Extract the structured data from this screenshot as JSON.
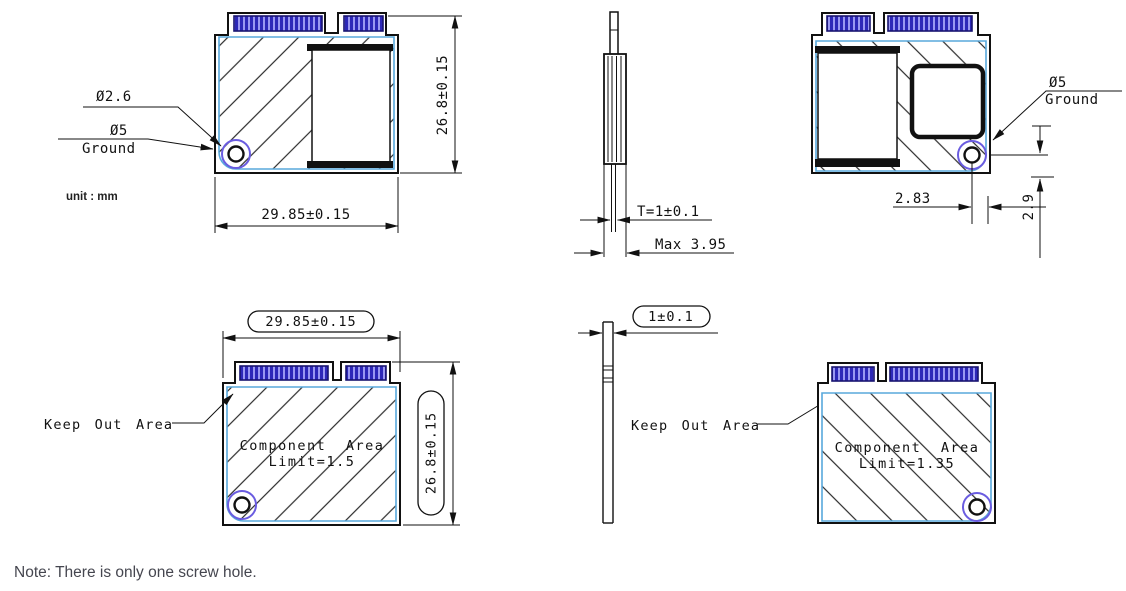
{
  "note": "Note: There is only one screw hole.",
  "unit_label": "unit : mm",
  "colors": {
    "pin_blue": "#2d28b8",
    "pin_blue_light": "#9a98f2",
    "pin_border_navy": "#181470",
    "board_outline_blue": "#58a8dc",
    "ground_ring_purple": "#6a5ce0",
    "line_black": "#111111",
    "note_gray": "#45464f"
  },
  "views": {
    "front": {
      "screw_hole_diameter_label": "Ø2.6",
      "ground_pad_diameter_label": "Ø5",
      "ground_label": "Ground",
      "width_dim": "29.85±0.15",
      "height_dim": "26.8±0.15"
    },
    "side_top": {
      "thickness_dim": "T=1±0.1",
      "max_thickness_dim": "Max 3.95"
    },
    "back": {
      "ground_pad_diameter_label": "Ø5",
      "ground_label": "Ground",
      "hole_offset_x_dim": "2.83",
      "hole_offset_y_dim": "2.9"
    },
    "bottom_front": {
      "width_dim": "29.85±0.15",
      "height_dim": "26.8±0.15",
      "keep_out_label": "Keep Out Area",
      "component_area_label": "Component Area",
      "component_limit_label": "Limit=1.5"
    },
    "side_bottom": {
      "thickness_dim": "1±0.1",
      "keep_out_label": "Keep Out Area"
    },
    "bottom_back": {
      "component_area_label": "Component Area",
      "component_limit_label": "Limit=1.35"
    }
  }
}
